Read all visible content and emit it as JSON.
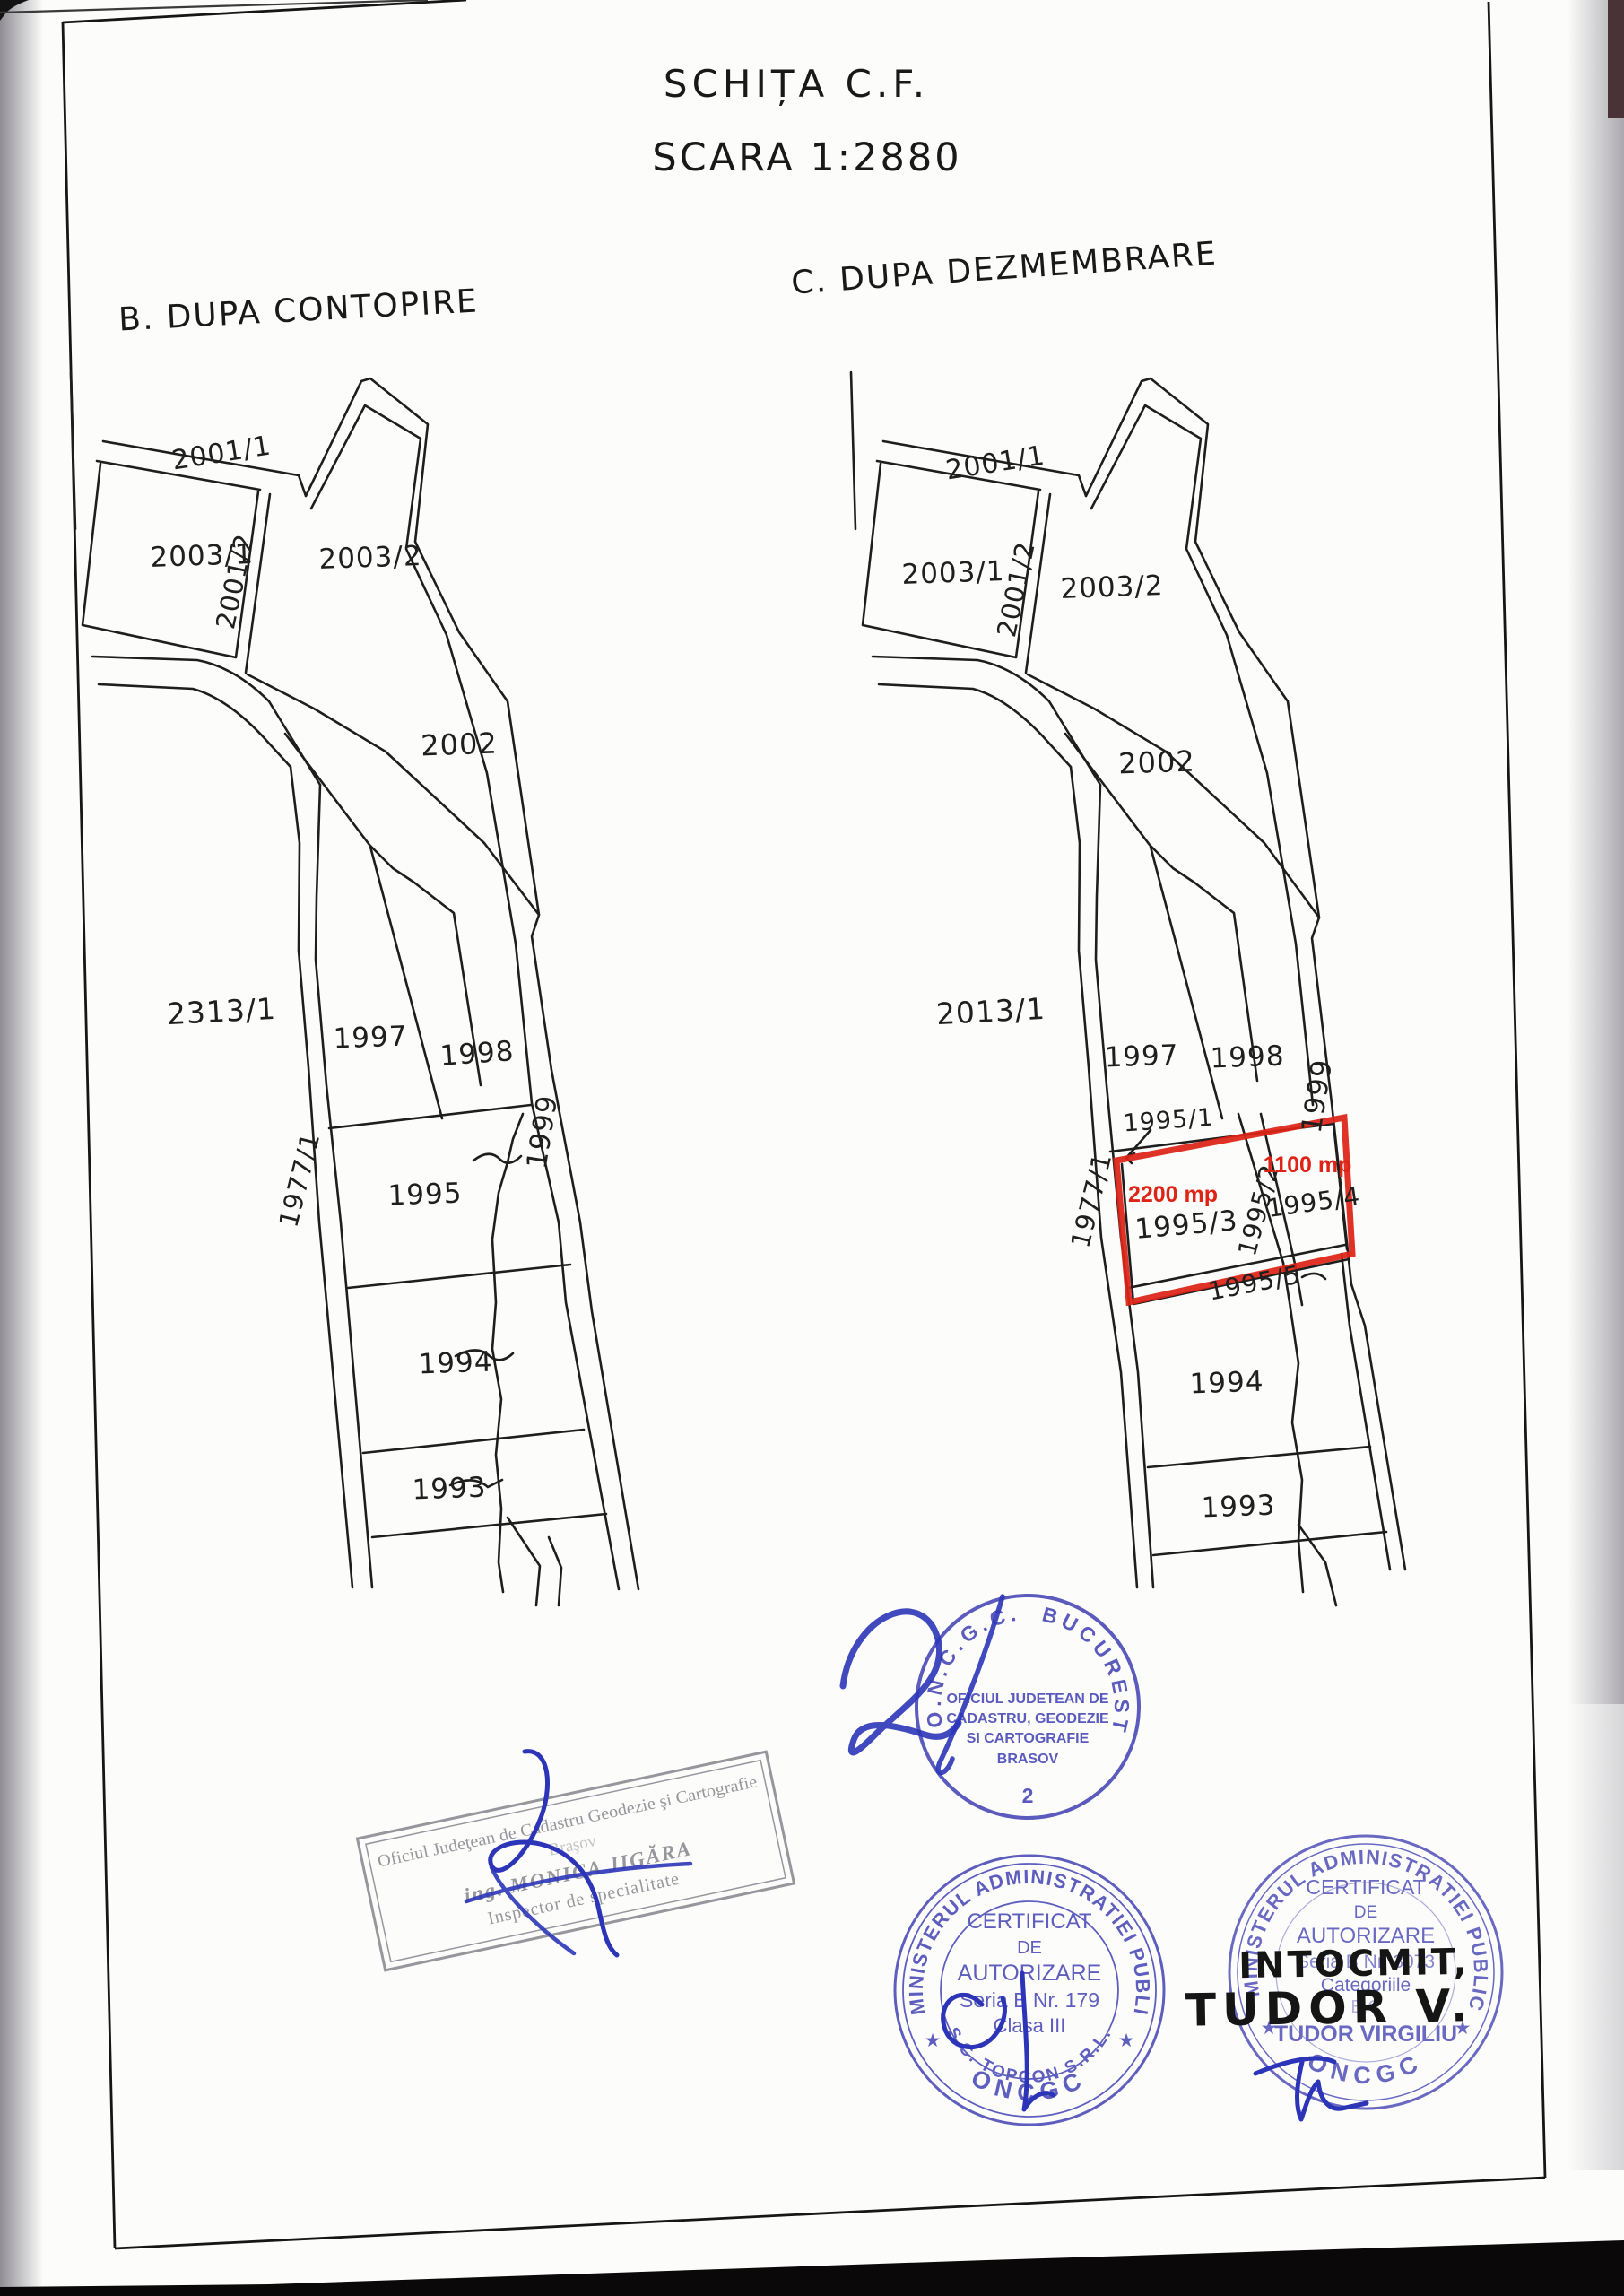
{
  "page": {
    "title_line1": "SCHIȚA C.F.",
    "title_line2": "SCARA 1:2880"
  },
  "diagram_b": {
    "heading": "B. DUPA CONTOPIRE",
    "labels": [
      "2001/1",
      "2003/1",
      "2001/2",
      "2003/2",
      "2002",
      "2313/1",
      "1997",
      "1998",
      "1999",
      "1977/1",
      "1995",
      "1994",
      "1993"
    ]
  },
  "diagram_c": {
    "heading": "C. DUPA DEZMEMBRARE",
    "labels": [
      "2001/1",
      "2003/1",
      "2001/2",
      "2003/2",
      "2002",
      "2013/1",
      "1997",
      "1998",
      "1999",
      "1977/1",
      "1995/1",
      "1995/3",
      "1995/2",
      "1995/4",
      "1995/5",
      "1994",
      "1993"
    ],
    "area_2200": "2200 mp",
    "area_1100": "1100 mp",
    "highlight_color": "#de2317"
  },
  "stamps": {
    "oncgc": {
      "arc_left": "O.N.C.G.C.",
      "arc_right": "BUCURESTI",
      "line1": "OFICIUL JUDETEAN DE",
      "line2": "CADASTRU, GEODEZIE",
      "line3": "SI CARTOGRAFIE",
      "line4": "BRASOV",
      "number": "2",
      "handwritten_number": "2",
      "ink_color": "#4545b5"
    },
    "inspector": {
      "line1": "Oficiul Judeţean de Cadastru Geodezie şi Cartografie",
      "line2": "Braşov",
      "line3": "ing. MONICA JIGĂRA",
      "line4": "Inspector de specialitate",
      "ink_color": "#85858d"
    },
    "topcon": {
      "arc_top": "MINISTERUL ADMINISTRATIEI PUBLICE",
      "arc_bottom": "ONCGC",
      "arc_inner": "S.C. TOPCON S.R.L.",
      "star": "★",
      "line1": "CERTIFICAT",
      "line2": "DE",
      "line3": "AUTORIZARE",
      "line4": "Seria B Nr. 179",
      "line5": "Clasa III",
      "ink_color": "#4545b5"
    },
    "tudor": {
      "arc_top": "MINISTERUL ADMINISTRATIEI PUBLICE",
      "arc_bottom": "ONCGC",
      "star": "★",
      "line1": "CERTIFICAT",
      "line2": "DE",
      "line3": "AUTORIZARE",
      "line4": "Seria B Nr. 3073",
      "line5": "Categoriile",
      "line6": "B,C",
      "line7": "TUDOR VIRGILIU",
      "handwritten1": "INTOCMIT,",
      "handwritten2": "TUDOR V.",
      "ink_color": "#4545b5",
      "handwriting_color": "#151515"
    }
  }
}
